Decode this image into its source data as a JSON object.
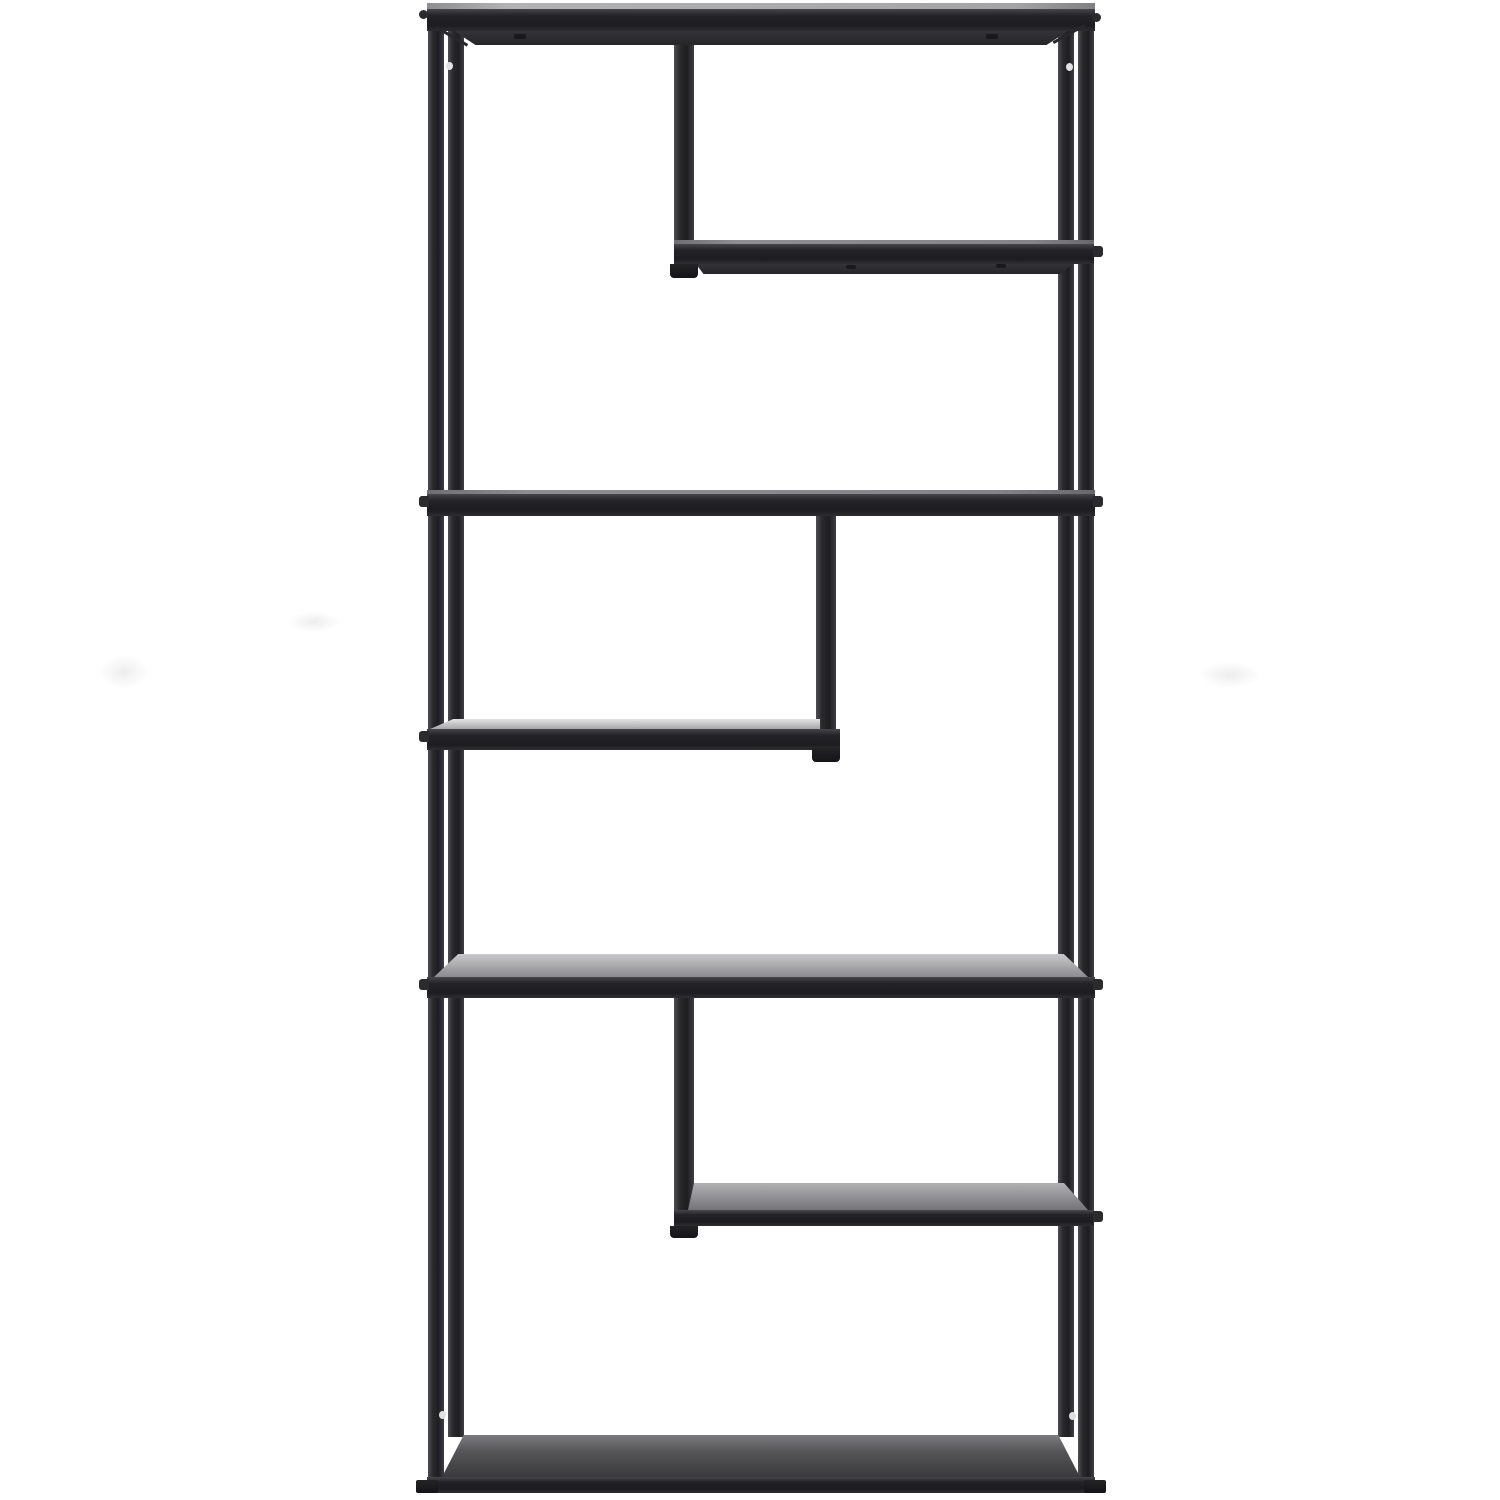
{
  "scene": {
    "description": "Studio product photo of a tall black metal etagere bookshelf with six staggered open shelves, photographed straight-on against a seamless white background",
    "background_color": "#ffffff",
    "canvas": {
      "width": 1500,
      "height": 1500
    },
    "palette": {
      "frame_dark": "#1e1e21",
      "frame_highlight": "#4e4e52",
      "shelf_surface_light": "#e4e4e6",
      "shelf_surface_mid": "#8b8b8f",
      "shelf_surface_dark": "#3a3a3d",
      "screw_hole_light": "#e0e0e2",
      "background_smudge": "#ededee"
    }
  },
  "styles": {
    "leg": "linear-gradient(90deg,#4e4e52 0%,#2a2a2d 30%,#1e1e21 65%,#3f3f43 100%)",
    "bar": "linear-gradient(180deg,#47474b 0%,#242428 30%,#1d1d20 75%,#2e2e32 100%)",
    "underside": "linear-gradient(180deg,#333337,#26262a)",
    "topline": "linear-gradient(90deg,#8e8e90,#b2b2b4 12%,#a4a4a6 88%,#808082)",
    "edgeline": "linear-gradient(90deg,#6f6f73,#8e8e92 15%,#84848a 85%,#68686c)",
    "surfaceL1": "linear-gradient(180deg,#e4e4e6,#a6a6a8)",
    "surfaceF2": "linear-gradient(180deg,#c9c9cb,#8b8b8f)",
    "surfaceR2": "linear-gradient(180deg,#b1b1b3,#747478)",
    "surfaceBottom": "linear-gradient(180deg,#7c7c7f 0%,#555558 40%,#3a3a3d 100%)",
    "foot": "linear-gradient(180deg,#232326,#141416)",
    "smudge": "radial-gradient(ellipse at center,#ededee 0%,rgba(255,255,255,0) 72%)",
    "gusset": "#28282b",
    "bump": "#2b2b2e",
    "screwDark": "#19191b",
    "screwHole": "#e0e0e2"
  },
  "elements": [
    {
      "name": "background-smudge-left-upper",
      "x": 288,
      "y": 612,
      "w": 52,
      "h": 20,
      "bg": "$smudge"
    },
    {
      "name": "background-smudge-left-lower",
      "x": 100,
      "y": 655,
      "w": 48,
      "h": 34,
      "bg": "$smudge"
    },
    {
      "name": "background-smudge-right",
      "x": 1200,
      "y": 662,
      "w": 60,
      "h": 26,
      "bg": "$smudge"
    },
    {
      "name": "left-back-leg",
      "x": 448,
      "y": 26,
      "w": 16,
      "h": 1411,
      "bg": "$leg"
    },
    {
      "name": "right-back-leg",
      "x": 1058,
      "y": 26,
      "w": 16,
      "h": 1411,
      "bg": "$leg"
    },
    {
      "name": "left-front-leg",
      "x": 428,
      "y": 8,
      "w": 16,
      "h": 1474,
      "bg": "$leg"
    },
    {
      "name": "right-front-leg",
      "x": 1078,
      "y": 8,
      "w": 16,
      "h": 1474,
      "bg": "$leg"
    },
    {
      "name": "middle-post-top",
      "x": 674,
      "y": 26,
      "w": 20,
      "h": 230,
      "bg": "$leg"
    },
    {
      "name": "middle-post-middle",
      "x": 816,
      "y": 502,
      "w": 20,
      "h": 250,
      "bg": "$leg"
    },
    {
      "name": "middle-post-bottom",
      "x": 674,
      "y": 992,
      "w": 20,
      "h": 236,
      "bg": "$leg"
    },
    {
      "name": "top-shelf-top-edge",
      "x": 427,
      "y": 3,
      "w": 668,
      "h": 7,
      "bg": "$topline"
    },
    {
      "name": "top-shelf-bar",
      "x": 427,
      "y": 9,
      "w": 668,
      "h": 22,
      "bg": "$bar"
    },
    {
      "name": "top-shelf-underside",
      "x": 454,
      "y": 31,
      "w": 614,
      "h": 14,
      "bg": "$underside",
      "clip": "polygon(0 0,100% 0,96.5% 100%,3.5% 100%)"
    },
    {
      "name": "top-shelf-left-gusset",
      "x": 437,
      "y": 26,
      "w": 36,
      "h": 3,
      "bg": "$gusset",
      "transform": "rotate(30deg)",
      "origin": "0 0"
    },
    {
      "name": "top-shelf-right-gusset",
      "x": 1054,
      "y": 41,
      "w": 36,
      "h": 3,
      "bg": "$gusset",
      "transform": "rotate(-29deg)",
      "origin": "0 100%"
    },
    {
      "name": "top-shelf-underside-screw-left",
      "x": 514,
      "y": 34,
      "w": 12,
      "h": 5,
      "bg": "$screwDark",
      "radius": "2px"
    },
    {
      "name": "top-shelf-underside-screw-right",
      "x": 986,
      "y": 34,
      "w": 12,
      "h": 5,
      "bg": "$screwDark",
      "radius": "2px"
    },
    {
      "name": "top-corner-screw-left",
      "x": 419,
      "y": 10,
      "w": 9,
      "h": 9,
      "bg": "$bump",
      "radius": "50%"
    },
    {
      "name": "top-corner-screw-right",
      "x": 1092,
      "y": 13,
      "w": 9,
      "h": 9,
      "bg": "$bump",
      "radius": "50%"
    },
    {
      "name": "shelf-upper-right-top-edge",
      "x": 674,
      "y": 240,
      "w": 420,
      "h": 4,
      "bg": "$edgeline"
    },
    {
      "name": "shelf-upper-right-bar",
      "x": 674,
      "y": 244,
      "w": 420,
      "h": 20,
      "bg": "$bar"
    },
    {
      "name": "shelf-upper-right-underside",
      "x": 696,
      "y": 264,
      "w": 376,
      "h": 10,
      "bg": "$underside",
      "clip": "polygon(0 0,100% 0,97% 100%,2% 100%)"
    },
    {
      "name": "shelf-upper-right-screw-a",
      "x": 846,
      "y": 265,
      "w": 10,
      "h": 4,
      "bg": "$screwDark",
      "radius": "2px"
    },
    {
      "name": "shelf-upper-right-screw-b",
      "x": 996,
      "y": 264,
      "w": 10,
      "h": 4,
      "bg": "$screwDark",
      "radius": "2px"
    },
    {
      "name": "middle-post-top-foot",
      "x": 670,
      "y": 264,
      "w": 28,
      "h": 14,
      "bg": "$foot",
      "radius": "0 0 4px 4px"
    },
    {
      "name": "side-screw-right-upper",
      "x": 1093,
      "y": 246,
      "w": 10,
      "h": 11,
      "bg": "$bump",
      "radius": "0 3px 3px 0"
    },
    {
      "name": "shelf-full-upper-top-edge",
      "x": 427,
      "y": 490,
      "w": 668,
      "h": 4,
      "bg": "$edgeline"
    },
    {
      "name": "shelf-full-upper-bar",
      "x": 427,
      "y": 494,
      "w": 668,
      "h": 22,
      "bg": "$bar"
    },
    {
      "name": "side-screw-left-f1",
      "x": 419,
      "y": 496,
      "w": 10,
      "h": 11,
      "bg": "$bump",
      "radius": "3px 0 0 3px"
    },
    {
      "name": "side-screw-right-f1",
      "x": 1093,
      "y": 496,
      "w": 10,
      "h": 11,
      "bg": "$bump",
      "radius": "0 3px 3px 0"
    },
    {
      "name": "shelf-mid-left-surface",
      "x": 430,
      "y": 719,
      "w": 390,
      "h": 10,
      "bg": "$surfaceL1",
      "clip": "polygon(6% 0,100% 0,100% 100%,0 100%)"
    },
    {
      "name": "shelf-mid-left-bar",
      "x": 427,
      "y": 729,
      "w": 413,
      "h": 21,
      "bg": "$bar"
    },
    {
      "name": "middle-post-middle-foot",
      "x": 812,
      "y": 748,
      "w": 28,
      "h": 14,
      "bg": "$foot",
      "radius": "0 0 4px 4px"
    },
    {
      "name": "side-screw-left-l1",
      "x": 419,
      "y": 731,
      "w": 10,
      "h": 11,
      "bg": "$bump",
      "radius": "3px 0 0 3px"
    },
    {
      "name": "shelf-full-lower-surface",
      "x": 434,
      "y": 954,
      "w": 654,
      "h": 23,
      "bg": "$surfaceF2",
      "clip": "polygon(3.7% 0,96.3% 0,100% 100%,0 100%)"
    },
    {
      "name": "shelf-full-lower-bar",
      "x": 427,
      "y": 977,
      "w": 668,
      "h": 21,
      "bg": "$bar"
    },
    {
      "name": "side-screw-left-f2",
      "x": 419,
      "y": 979,
      "w": 10,
      "h": 11,
      "bg": "$bump",
      "radius": "3px 0 0 3px"
    },
    {
      "name": "side-screw-right-f2",
      "x": 1093,
      "y": 979,
      "w": 10,
      "h": 11,
      "bg": "$bump",
      "radius": "0 3px 3px 0"
    },
    {
      "name": "shelf-lower-right-surface",
      "x": 688,
      "y": 1183,
      "w": 400,
      "h": 27,
      "bg": "$surfaceR2",
      "clip": "polygon(1.5% 0,94% 0,100% 100%,0 100%)"
    },
    {
      "name": "shelf-lower-right-bar",
      "x": 674,
      "y": 1210,
      "w": 420,
      "h": 16,
      "bg": "$bar"
    },
    {
      "name": "middle-post-bottom-foot",
      "x": 670,
      "y": 1226,
      "w": 28,
      "h": 12,
      "bg": "$foot",
      "radius": "0 0 4px 4px"
    },
    {
      "name": "side-screw-right-r2",
      "x": 1093,
      "y": 1211,
      "w": 10,
      "h": 11,
      "bg": "$bump",
      "radius": "0 3px 3px 0"
    },
    {
      "name": "bottom-shelf-surface",
      "x": 442,
      "y": 1435,
      "w": 638,
      "h": 42,
      "bg": "$surfaceBottom",
      "clip": "polygon(3.4% 0,96.6% 0,100% 100%,0 100%)"
    },
    {
      "name": "bottom-shelf-bar",
      "x": 427,
      "y": 1477,
      "w": 668,
      "h": 16,
      "bg": "$bar"
    },
    {
      "name": "bottom-foot-left",
      "x": 416,
      "y": 1480,
      "w": 22,
      "h": 13,
      "bg": "$foot",
      "radius": "2px"
    },
    {
      "name": "bottom-foot-right",
      "x": 1084,
      "y": 1480,
      "w": 22,
      "h": 13,
      "bg": "$foot",
      "radius": "2px"
    },
    {
      "name": "screw-hole-top-left",
      "x": 446,
      "y": 62,
      "w": 7,
      "h": 8,
      "bg": "$screwHole",
      "radius": "50%"
    },
    {
      "name": "screw-hole-top-right",
      "x": 1066,
      "y": 63,
      "w": 7,
      "h": 8,
      "bg": "$screwHole",
      "radius": "50%"
    },
    {
      "name": "screw-hole-bottom-left",
      "x": 439,
      "y": 1411,
      "w": 7,
      "h": 8,
      "bg": "$screwHole",
      "radius": "50%"
    },
    {
      "name": "screw-hole-bottom-right",
      "x": 1069,
      "y": 1412,
      "w": 7,
      "h": 8,
      "bg": "$screwHole",
      "radius": "50%"
    }
  ]
}
